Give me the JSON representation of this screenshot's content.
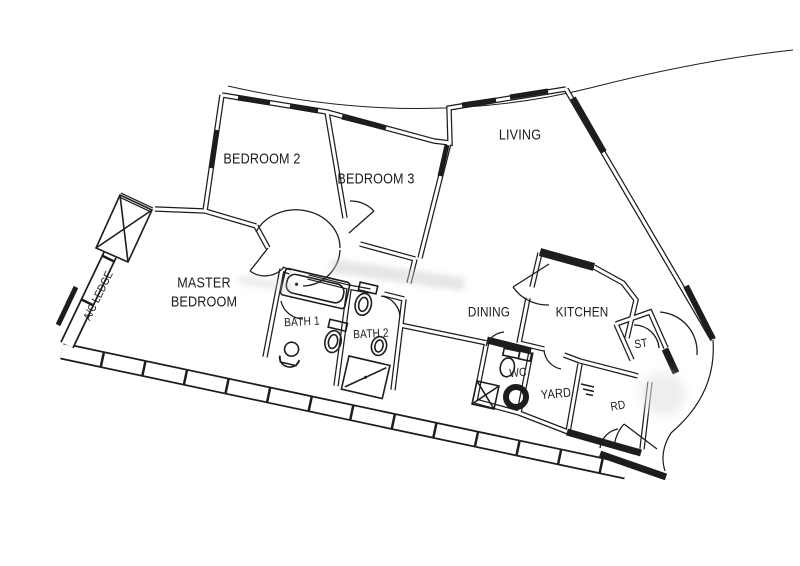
{
  "plan": {
    "background_color": "#ffffff",
    "line_color": "#1d1d1d",
    "rooms": [
      {
        "id": "bedroom-2",
        "label": "BEDROOM 2",
        "x": 262,
        "y": 160,
        "fs": 15,
        "rot": 0
      },
      {
        "id": "bedroom-3",
        "label": "BEDROOM 3",
        "x": 376,
        "y": 180,
        "fs": 15,
        "rot": 0
      },
      {
        "id": "living",
        "label": "LIVING",
        "x": 520,
        "y": 136,
        "fs": 15,
        "rot": 0
      },
      {
        "id": "master-bedroom",
        "label": "MASTER\nBEDROOM",
        "x": 204,
        "y": 293,
        "fs": 15,
        "rot": 0
      },
      {
        "id": "ac-ledge",
        "label": "A/C LEDGE",
        "x": 99,
        "y": 296,
        "fs": 11.5,
        "rot": -64
      },
      {
        "id": "bath-1",
        "label": "BATH 1",
        "x": 302,
        "y": 322,
        "fs": 12,
        "rot": -3
      },
      {
        "id": "bath-2",
        "label": "BATH 2",
        "x": 371,
        "y": 334,
        "fs": 12,
        "rot": -3
      },
      {
        "id": "dining",
        "label": "DINING",
        "x": 489,
        "y": 312,
        "fs": 14,
        "rot": 0
      },
      {
        "id": "kitchen",
        "label": "KITCHEN",
        "x": 582,
        "y": 312,
        "fs": 14,
        "rot": 0
      },
      {
        "id": "st",
        "label": "ST",
        "x": 641,
        "y": 344,
        "fs": 12,
        "rot": -8
      },
      {
        "id": "wc",
        "label": "WC",
        "x": 518,
        "y": 373,
        "fs": 12,
        "rot": -5
      },
      {
        "id": "yard",
        "label": "YARD",
        "x": 556,
        "y": 394,
        "fs": 13,
        "rot": -5
      },
      {
        "id": "shelter",
        "label": "RD",
        "x": 618,
        "y": 406,
        "fs": 12,
        "rot": -10
      }
    ],
    "symbols": [
      "bathtub-icon",
      "toilet-icon",
      "basin-icon",
      "shower-icon",
      "floor-trap-icon",
      "riser-shaft-icon",
      "ac-unit-icon",
      "washer-point-icon",
      "door-swing-arc",
      "window-sill"
    ]
  }
}
